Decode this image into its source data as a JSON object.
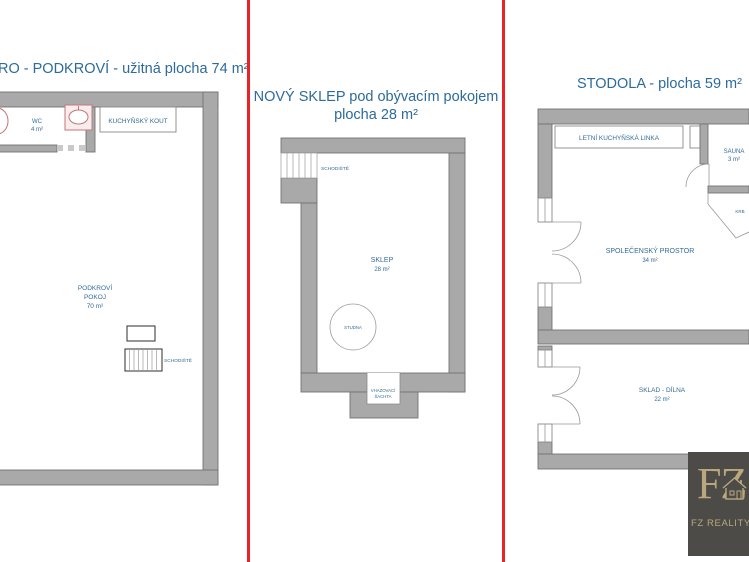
{
  "colors": {
    "accent_red": "#ea2127",
    "wall_gray": "#a9a9a9",
    "text_blue": "#2c6b9b",
    "fixture_pink": "#c4767c",
    "logo_bg": "#4c4b47",
    "logo_gold": "#b9a87e"
  },
  "left_panel": {
    "title": "RO - PODKROVÍ - užitná plocha 74 m²",
    "wc_name": "WC",
    "wc_area": "4 m²",
    "kitchen_label": "KUCHYŇSKÝ KOUT",
    "room_line1": "PODKROVÍ",
    "room_line2": "POKOJ",
    "room_area": "70 m²",
    "stairs_label": "SCHODIŠTĚ"
  },
  "middle_panel": {
    "title_line1": "NOVÝ SKLEP pod obývacím pokojem",
    "title_line2": "plocha 28 m²",
    "stairs_label": "SCHODIŠTĚ",
    "room_name": "SKLEP",
    "room_area": "28 m²",
    "well_label": "STUDNA",
    "shaft_line1": "VHAZOVACÍ",
    "shaft_line2": "ŠACHTA"
  },
  "right_panel": {
    "title": "STODOLA - plocha 59 m²",
    "kitchen_label": "LETNÍ KUCHYŇSKÁ LINKA",
    "sauna_name": "SAUNA",
    "sauna_area": "3 m²",
    "fireplace_label": "KRB",
    "social_name": "SPOLEČENSKÝ PROSTOR",
    "social_area": "34 m²",
    "workshop_name": "SKLAD - DÍLNA",
    "workshop_area": "22 m²"
  },
  "logo": {
    "monogram": "FZ",
    "name": "FZ REALITY"
  }
}
